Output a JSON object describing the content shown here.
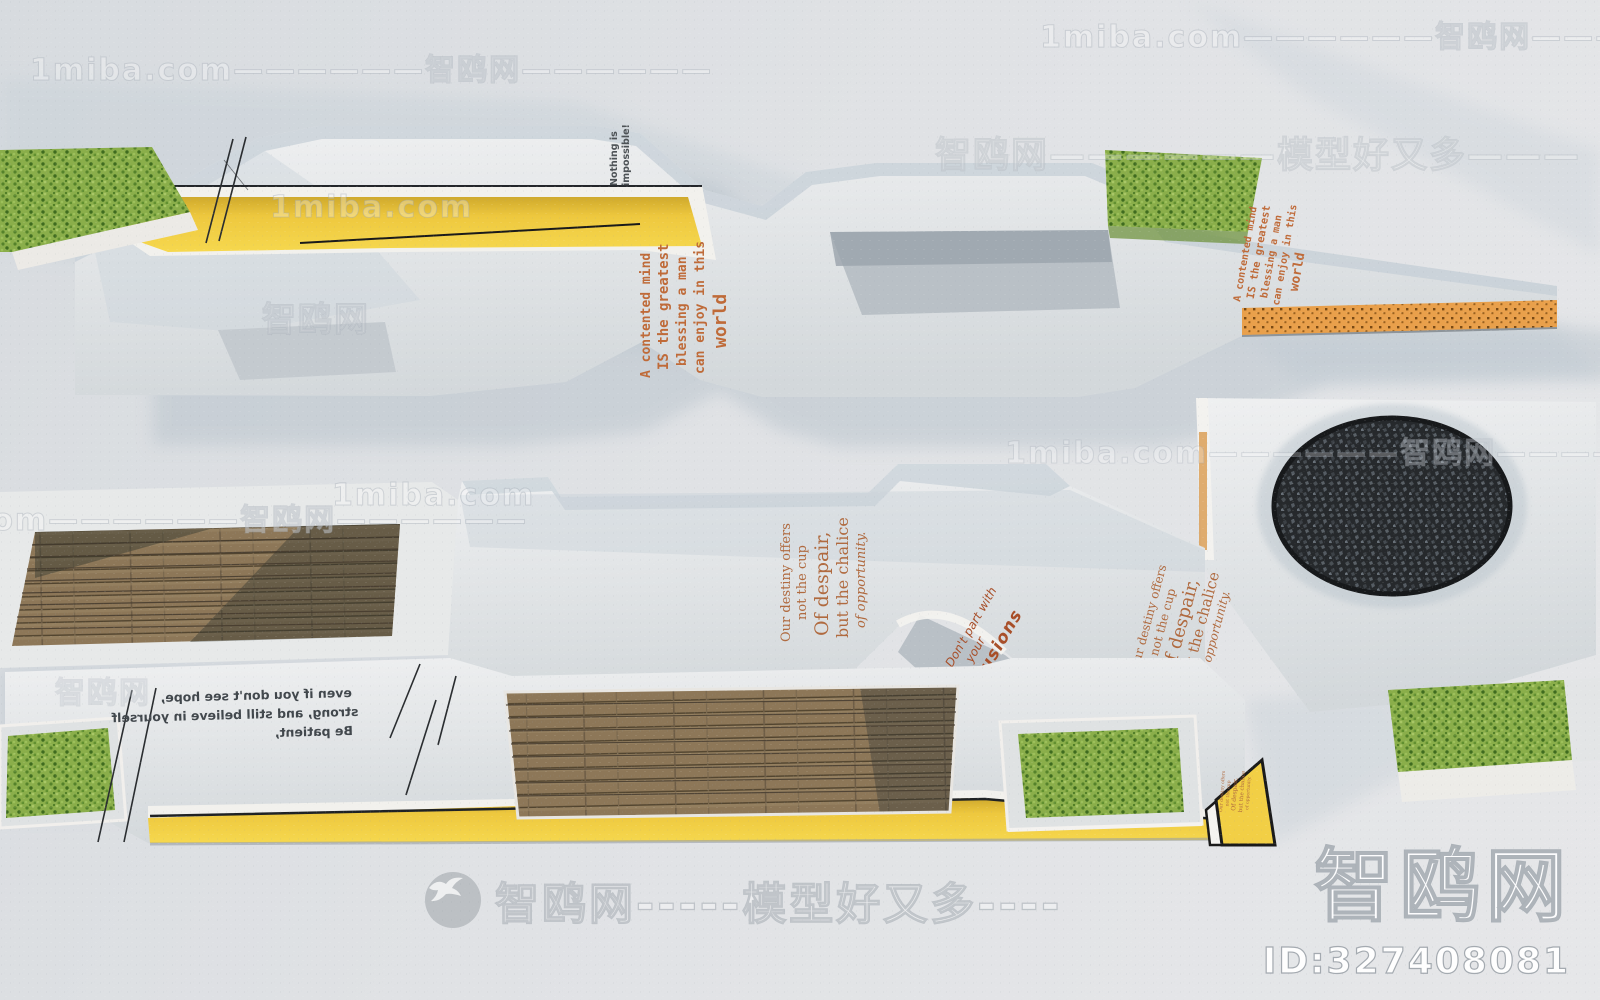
{
  "watermarks": {
    "site": "1miba.com",
    "brand": "智鸥网",
    "tile": "1miba.com——————智鸥网——————",
    "brand_tagline": "智鸥网——————模型好又多———",
    "brand_tagline_center": "智鸥网-----模型好又多----",
    "brand_big": "智鸥网",
    "id_label": "ID:327408081"
  },
  "quotes": {
    "contented": {
      "lines": [
        "A contented mind",
        "IS the greatest",
        "blessing a man",
        "can enjoy in this",
        "world"
      ]
    },
    "nothing": {
      "lines": [
        "Nothing is",
        "impossible!"
      ]
    },
    "destiny": {
      "lines": [
        "Our destiny offers",
        "not the cup",
        "Of despair,",
        "but the chalice",
        "of opportunity."
      ]
    },
    "illusions": {
      "lines": [
        "Don't part with",
        "your",
        "illusions"
      ]
    },
    "patient_mirrored": {
      "lines": [
        "even if you don't see hope,",
        "strong, and still believe in yourself",
        "Be patient,"
      ]
    }
  },
  "colors": {
    "background": "#e0e2e5",
    "concrete_light": "#e6e8e9",
    "concrete_top_tint": "#c5cfd7",
    "yellow_accent": "#f2cf45",
    "grass_green": "#8aae4a",
    "wood_brown": "#8d7758",
    "gravel_dark": "#26292c",
    "orange_perforated": "#e9a04b",
    "orange_text": "#bf6a38"
  }
}
